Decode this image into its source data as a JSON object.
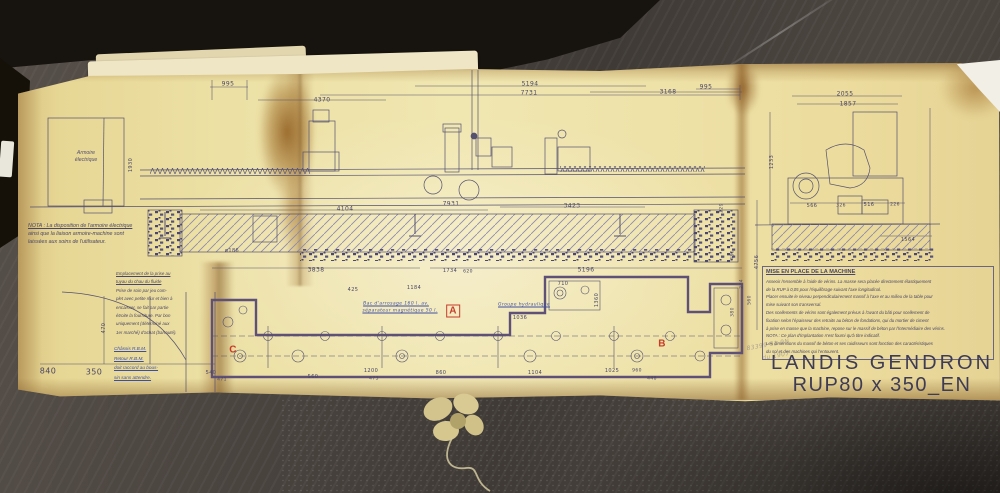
{
  "scene": {
    "table_color": "#4a443f",
    "binder_color": "#17130f",
    "paper_color": "#ece0a4",
    "ink_color": "#54506f",
    "plan_outline_color": "#5e5077",
    "red_mark_color": "#c63b2a",
    "blue_note_color": "#3f4fa0"
  },
  "paper": {
    "cabinet_label_lines": [
      "Armoire",
      "électrique"
    ],
    "left_nota_lines": [
      "NOTA : La disposition de l'armoire électrique",
      "ainsi que la liaison armoire-machine sont",
      "laissées aux soins de l'utilisateur."
    ],
    "hand_note_lines": [
      "Emplacement de la prise au",
      "tuyau du chau du fluide",
      "Prise de soin par jeu com-",
      "plet avec petite mur et bien à",
      "encaisser, se fait par partie",
      "étroite la fourniture. Par bon",
      "uniquement (déterminé aux",
      "1er marché) d'achat (barrauté)."
    ],
    "blue_note_lines": [
      "Châssis R.B.M.",
      "Retour R.B.M.",
      "doit raccord au bous-",
      "sin sans attendre."
    ],
    "right_block": {
      "heading": "MISE EN PLACE DE LA MACHINE",
      "lines": [
        "Asseoir l'ensemble à l'aide de vérins. La masse sera placée directement élastiquement",
        "de la RUP à 0,05 pour l'équilibrage suivant l'axe longitudinal.",
        "Placer ensuite le niveau perpendiculairement massif à l'axe et au milieu de la table pour",
        "mise suivant son transversal.",
        "Des scellements de vérins sont également prévus à l'avant du bâti pour scellement de",
        "fixation selon l'épaisseur des retraits au béton de fondations, qui du mortier de ciment",
        "à prise en masse que la machine, repose sur le massif de béton par l'intermédiaire des vérins.",
        "NOTA : Ce plan d'implantation n'est fourni qu'à titre indicatif.",
        "Les dimensions du massif de béton et ses raidisseurs sont fonction des caractéristiques",
        "du sol et des machines qui l'entourent."
      ]
    },
    "title_block": {
      "line1": "LANDIS GENDRON",
      "line2": "RUP80 x 350_EN 3047"
    },
    "labels": [
      {
        "t": "995",
        "x": 228,
        "y": 84
      },
      {
        "t": "4370",
        "x": 322,
        "y": 100
      },
      {
        "t": "5194",
        "x": 530,
        "y": 84
      },
      {
        "t": "7731",
        "x": 529,
        "y": 93
      },
      {
        "t": "3168",
        "x": 668,
        "y": 92
      },
      {
        "t": "995",
        "x": 706,
        "y": 87
      },
      {
        "t": "2055",
        "x": 845,
        "y": 94
      },
      {
        "t": "1857",
        "x": 848,
        "y": 104
      },
      {
        "t": "4104",
        "x": 345,
        "y": 209
      },
      {
        "t": "7931",
        "x": 451,
        "y": 204
      },
      {
        "t": "3423",
        "x": 572,
        "y": 206
      },
      {
        "t": "ø186",
        "x": 232,
        "y": 251,
        "s": 5
      },
      {
        "t": "3838",
        "x": 316,
        "y": 270
      },
      {
        "t": "5196",
        "x": 586,
        "y": 270
      },
      {
        "t": "1734",
        "x": 450,
        "y": 271,
        "s": 5
      },
      {
        "t": "425",
        "x": 353,
        "y": 290,
        "s": 5
      },
      {
        "t": "1184",
        "x": 414,
        "y": 288,
        "s": 5
      },
      {
        "t": "620",
        "x": 468,
        "y": 272,
        "s": 4.5
      },
      {
        "t": "710",
        "x": 563,
        "y": 284,
        "s": 5
      },
      {
        "t": "1360",
        "x": 597,
        "y": 300,
        "s": 5,
        "r": -90
      },
      {
        "t": "1036",
        "x": 520,
        "y": 318,
        "s": 5
      },
      {
        "t": "540",
        "x": 211,
        "y": 373,
        "s": 5
      },
      {
        "t": "471",
        "x": 222,
        "y": 380,
        "s": 4.5
      },
      {
        "t": "560",
        "x": 313,
        "y": 377,
        "s": 5
      },
      {
        "t": "1200",
        "x": 371,
        "y": 371,
        "s": 5
      },
      {
        "t": "473",
        "x": 374,
        "y": 379,
        "s": 4.5
      },
      {
        "t": "860",
        "x": 441,
        "y": 373,
        "s": 5
      },
      {
        "t": "1104",
        "x": 535,
        "y": 373,
        "s": 5
      },
      {
        "t": "1025",
        "x": 612,
        "y": 371,
        "s": 5
      },
      {
        "t": "960",
        "x": 637,
        "y": 371,
        "s": 4.5
      },
      {
        "t": "448",
        "x": 652,
        "y": 379,
        "s": 4.5
      },
      {
        "t": "229",
        "x": 722,
        "y": 208,
        "s": 4.5,
        "r": -90
      },
      {
        "t": "480",
        "x": 733,
        "y": 255,
        "s": 4.5,
        "r": -90
      },
      {
        "t": "274",
        "x": 742,
        "y": 284,
        "s": 4.5,
        "r": -90
      },
      {
        "t": "380",
        "x": 733,
        "y": 312,
        "s": 4.5,
        "r": -90
      },
      {
        "t": "560",
        "x": 750,
        "y": 300,
        "s": 4.5,
        "r": -90
      },
      {
        "t": "4756",
        "x": 757,
        "y": 262,
        "s": 5,
        "r": -90
      },
      {
        "t": "1930",
        "x": 131,
        "y": 165,
        "s": 5,
        "r": -90
      },
      {
        "t": "470",
        "x": 104,
        "y": 328,
        "s": 5,
        "r": -90
      },
      {
        "t": "840",
        "x": 48,
        "y": 371,
        "s": 8
      },
      {
        "t": "350",
        "x": 94,
        "y": 372,
        "s": 8
      },
      {
        "t": "566",
        "x": 812,
        "y": 206,
        "s": 5
      },
      {
        "t": "326",
        "x": 841,
        "y": 206,
        "s": 4.5
      },
      {
        "t": "516",
        "x": 869,
        "y": 205,
        "s": 5
      },
      {
        "t": "226",
        "x": 895,
        "y": 205,
        "s": 4.5
      },
      {
        "t": "1233",
        "x": 772,
        "y": 162,
        "s": 5,
        "r": -90
      },
      {
        "t": "1564",
        "x": 908,
        "y": 240,
        "s": 5
      },
      {
        "t": "C",
        "x": 233,
        "y": 350,
        "s": 10,
        "c": "red"
      },
      {
        "t": "A",
        "x": 453,
        "y": 311,
        "s": 10,
        "c": "red",
        "box": 1
      },
      {
        "t": "B",
        "x": 662,
        "y": 344,
        "s": 10,
        "c": "red"
      },
      {
        "t": "Bac d'arrosage 160 l. av.",
        "x": 396,
        "y": 304,
        "s": 4.5,
        "c": "blue"
      },
      {
        "t": "séparateur magnétique 50 l.",
        "x": 400,
        "y": 311,
        "s": 4.5,
        "c": "blue"
      },
      {
        "t": "Groupe hydraulique",
        "x": 524,
        "y": 305,
        "s": 4.5,
        "c": "blue"
      },
      {
        "t": "83399 51 9N",
        "x": 768,
        "y": 345,
        "s": 6,
        "c": "pencil",
        "r": -10
      },
      {
        "t": "du 1907",
        "x": 776,
        "y": 356,
        "s": 6,
        "c": "pencil",
        "r": -10
      }
    ]
  }
}
